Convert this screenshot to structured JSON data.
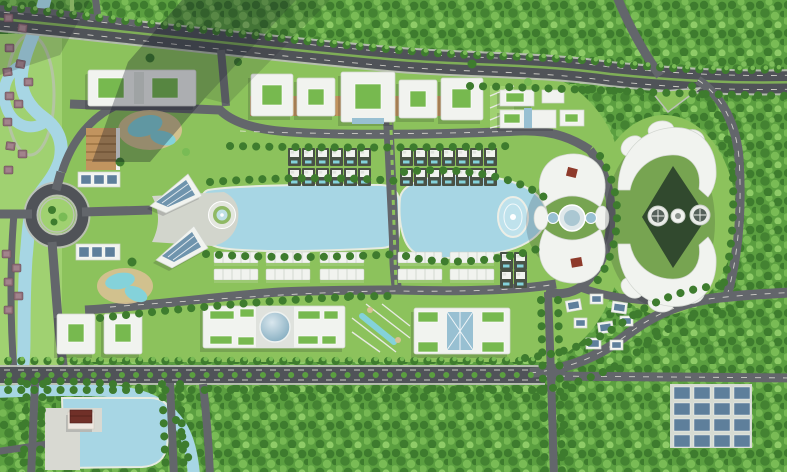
{
  "meta": {
    "title": "Lakeside eco-city master plan — aerial render",
    "description": "Top-down architectural rendering of a mixed-use lakeside development surrounded by dense forest",
    "image_width": 787,
    "image_height": 472
  },
  "palette": {
    "forest_deep": "#3e7c2e",
    "forest_mid": "#5b9f40",
    "forest_light": "#79bb55",
    "forest_pale": "#8ecb67",
    "lawn": "#8cc25c",
    "lawn_light": "#a0d171",
    "water": "#a7d6e4",
    "water_edge": "#e6ebe0",
    "road_major": "#505358",
    "road_minor": "#63666b",
    "road_line": "#eceae2",
    "sidewalk": "#bcc0b8",
    "plaza": "#d2d5cc",
    "building_white": "#f1f3ef",
    "building_edge": "#d2d6d0",
    "building_shade": "#dfe2dd",
    "roof_green": "#77b94f",
    "glass_blue": "#98c0d2",
    "glass_deep": "#6f94ad",
    "solar_panel": "#5e7f9b",
    "bronze": "#c1945f",
    "bronze_dark": "#9c7342",
    "accent_red": "#8e3a2b",
    "villa_plot": "#495246",
    "villa_roof": "#8b6b74",
    "villa_roof_dark": "#6d4f58",
    "pool_teal": "#84d2da",
    "sand": "#d8c193",
    "courtyard_dark": "#31492e",
    "shadow_band": "rgba(14,18,32,0.30)"
  },
  "scene": {
    "regions": [
      {
        "id": "forest",
        "label": "dense forest belt"
      },
      {
        "id": "highway",
        "label": "divided highway with green median"
      },
      {
        "id": "river",
        "label": "winding river, west side"
      },
      {
        "id": "canal",
        "label": "canal along south boulevard"
      },
      {
        "id": "roundabout",
        "label": "roundabout with green island"
      },
      {
        "id": "lake-west",
        "label": "west central lake"
      },
      {
        "id": "lake-east",
        "label": "east central lake with oval fountain island"
      },
      {
        "id": "circular-plaza",
        "label": "circular fountain plaza at lake head"
      },
      {
        "id": "mall-row",
        "label": "row of five courtyard mall blocks"
      },
      {
        "id": "villa-rows-north",
        "label": "pool-villa plots north of the lakes"
      },
      {
        "id": "townhouse-rows-south",
        "label": "townhouse rows south of the lakes"
      },
      {
        "id": "lotus-building",
        "label": "petal-shaped building with glass core"
      },
      {
        "id": "crescent-towers",
        "label": "twin-crescent building with round towers"
      },
      {
        "id": "dome-building",
        "label": "long slab building with central glass dome"
      },
      {
        "id": "atrium-building",
        "label": "slab building with linear glass atrium"
      },
      {
        "id": "office-cluster",
        "label": "cluster of small solar-roof buildings"
      },
      {
        "id": "solar-grid",
        "label": "gridded solar / parking field"
      },
      {
        "id": "temple-pond",
        "label": "pond with red-roof pavilion"
      },
      {
        "id": "resort-pools",
        "label": "free-form resort lagoon pools"
      },
      {
        "id": "boulevard",
        "label": "tree-lined boulevard"
      }
    ]
  }
}
